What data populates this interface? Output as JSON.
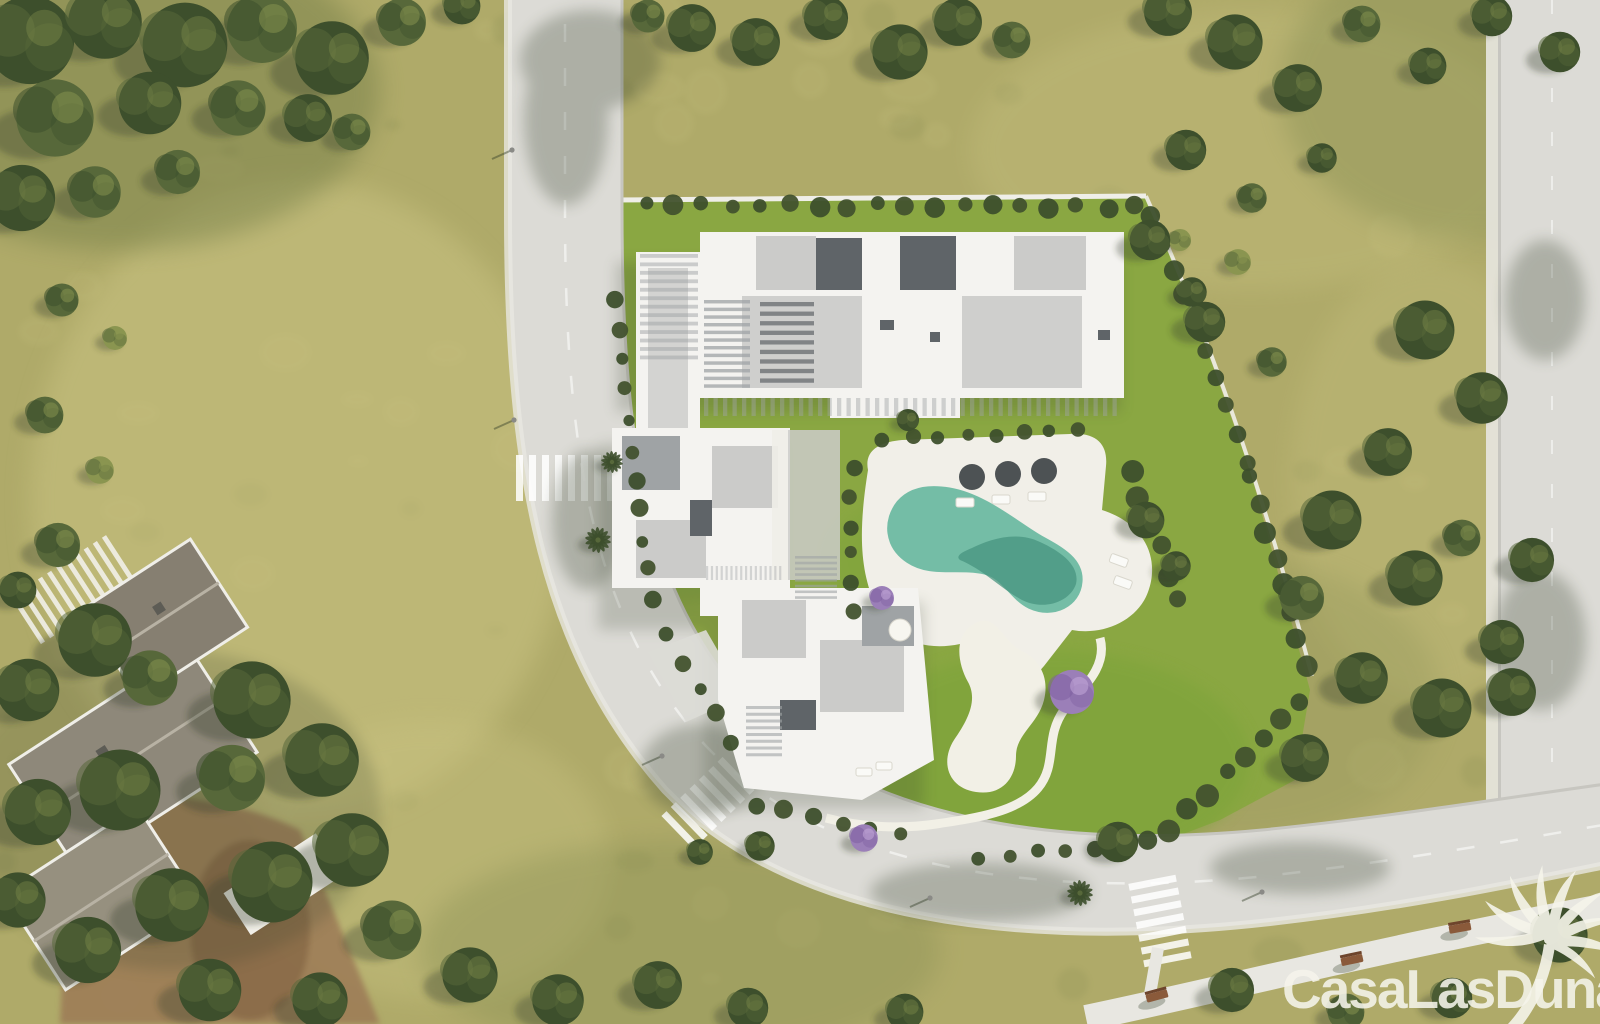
{
  "watermark": {
    "text": "CasaLasDunas",
    "logo": "palm-tree",
    "color": "#f5f4ea",
    "opacity": 0.88
  },
  "palette": {
    "grass_base": "#afaa69",
    "grass_light": "#cbc483",
    "grass_dark": "#868e52",
    "grass_deep": "#6f7a44",
    "plot_lawn": "#8aa742",
    "plot_lawn_light": "#a6ba50",
    "plot_lawn_bright": "#7aa338",
    "road": "#dcdbd6",
    "road_edge": "#c7c6c0",
    "sidewalk": "#e8e7e1",
    "white_line": "#ffffff",
    "building_white": "#f4f3f0",
    "roof_light": "#cbcbc9",
    "roof_mid": "#9fa3a5",
    "roof_dark": "#5f6468",
    "pool_teal": "#74bda6",
    "pool_deep": "#47947f",
    "deck_white": "#f1efe8",
    "sand_white": "#f2f0e6",
    "tree_dark": "#3d4f2c",
    "tree_mid": "#57683a",
    "tree_light": "#8a9550",
    "purple_tree": "#9b7fb8",
    "purple_deep": "#7d5fa0",
    "hedge": "#42522e",
    "shadow": "#36412a",
    "dirt": "#9c7a55",
    "dirt_dark": "#7a5a3e",
    "villa_roof_a": "#8e887a",
    "villa_roof_b": "#867f71",
    "villa_roof_c": "#96907f",
    "ridge": "#b8b2a4",
    "bench": "#8a5a3a",
    "bench_dark": "#6e452c",
    "umbrella_dark": "#3f4446",
    "wall_white": "#efeee8"
  },
  "scene": {
    "trees": [
      [
        30,
        40,
        48,
        "d"
      ],
      [
        105,
        22,
        40,
        "d"
      ],
      [
        185,
        45,
        46,
        "d"
      ],
      [
        262,
        28,
        38,
        "m"
      ],
      [
        332,
        58,
        40,
        "d"
      ],
      [
        55,
        118,
        42,
        "m"
      ],
      [
        150,
        103,
        34,
        "d"
      ],
      [
        238,
        108,
        30,
        "m"
      ],
      [
        22,
        198,
        36,
        "d"
      ],
      [
        95,
        192,
        28,
        "m"
      ],
      [
        402,
        22,
        26,
        "m"
      ],
      [
        462,
        6,
        20,
        "d"
      ],
      [
        308,
        118,
        26,
        "d"
      ],
      [
        178,
        172,
        24,
        "m"
      ],
      [
        352,
        132,
        20,
        "m"
      ],
      [
        648,
        16,
        18,
        "m"
      ],
      [
        692,
        28,
        26,
        "d"
      ],
      [
        756,
        42,
        26,
        "d"
      ],
      [
        826,
        18,
        24,
        "d"
      ],
      [
        900,
        52,
        30,
        "d"
      ],
      [
        958,
        22,
        26,
        "d"
      ],
      [
        1012,
        40,
        20,
        "m"
      ],
      [
        1168,
        12,
        26,
        "d"
      ],
      [
        1235,
        42,
        30,
        "d"
      ],
      [
        1298,
        88,
        26,
        "d"
      ],
      [
        1362,
        24,
        20,
        "m"
      ],
      [
        1428,
        66,
        20,
        "d"
      ],
      [
        1492,
        16,
        22,
        "d"
      ],
      [
        1560,
        52,
        22,
        "d"
      ],
      [
        1186,
        150,
        22,
        "d"
      ],
      [
        1252,
        198,
        16,
        "m"
      ],
      [
        1322,
        158,
        16,
        "d"
      ],
      [
        1205,
        322,
        22,
        "d"
      ],
      [
        1272,
        362,
        16,
        "m"
      ],
      [
        1425,
        330,
        32,
        "d"
      ],
      [
        1482,
        398,
        28,
        "d"
      ],
      [
        1388,
        452,
        26,
        "d"
      ],
      [
        1332,
        520,
        32,
        "d"
      ],
      [
        1415,
        578,
        30,
        "d"
      ],
      [
        1302,
        598,
        24,
        "m"
      ],
      [
        1362,
        678,
        28,
        "d"
      ],
      [
        1305,
        758,
        26,
        "d"
      ],
      [
        1442,
        708,
        32,
        "d"
      ],
      [
        1502,
        642,
        24,
        "d"
      ],
      [
        1462,
        538,
        20,
        "m"
      ],
      [
        1532,
        560,
        24,
        "d"
      ],
      [
        1512,
        692,
        26,
        "d"
      ],
      [
        1238,
        262,
        14,
        "l"
      ],
      [
        1180,
        240,
        12,
        "l"
      ],
      [
        62,
        300,
        18,
        "m"
      ],
      [
        115,
        338,
        13,
        "l"
      ],
      [
        45,
        415,
        20,
        "m"
      ],
      [
        100,
        470,
        15,
        "l"
      ],
      [
        58,
        545,
        24,
        "m"
      ],
      [
        18,
        590,
        20,
        "d"
      ],
      [
        95,
        640,
        40,
        "d"
      ],
      [
        28,
        690,
        34,
        "d"
      ],
      [
        150,
        678,
        30,
        "m"
      ],
      [
        252,
        700,
        42,
        "d"
      ],
      [
        322,
        760,
        40,
        "d"
      ],
      [
        232,
        778,
        36,
        "m"
      ],
      [
        120,
        790,
        44,
        "d"
      ],
      [
        38,
        812,
        36,
        "d"
      ],
      [
        352,
        850,
        40,
        "d"
      ],
      [
        272,
        882,
        44,
        "d"
      ],
      [
        172,
        905,
        40,
        "d"
      ],
      [
        88,
        950,
        36,
        "d"
      ],
      [
        392,
        930,
        32,
        "m"
      ],
      [
        470,
        975,
        30,
        "d"
      ],
      [
        558,
        1000,
        28,
        "d"
      ],
      [
        18,
        900,
        30,
        "d"
      ],
      [
        210,
        990,
        34,
        "d"
      ],
      [
        320,
        1000,
        30,
        "d"
      ],
      [
        658,
        985,
        26,
        "d"
      ],
      [
        748,
        1008,
        22,
        "d"
      ],
      [
        905,
        1012,
        20,
        "d"
      ],
      [
        1118,
        842,
        22,
        "d"
      ],
      [
        1232,
        990,
        24,
        "d"
      ],
      [
        1346,
        1012,
        20,
        "m"
      ],
      [
        1452,
        998,
        22,
        "d"
      ],
      [
        1560,
        935,
        30,
        "d"
      ],
      [
        1150,
        240,
        22,
        "d"
      ],
      [
        1192,
        292,
        16,
        "d"
      ],
      [
        908,
        420,
        12,
        "d"
      ],
      [
        1146,
        520,
        20,
        "d"
      ],
      [
        1176,
        566,
        16,
        "d"
      ],
      [
        882,
        598,
        13,
        "p"
      ],
      [
        1072,
        692,
        24,
        "p"
      ],
      [
        864,
        838,
        15,
        "p"
      ],
      [
        760,
        846,
        16,
        "d"
      ],
      [
        700,
        852,
        14,
        "d"
      ],
      [
        598,
        540,
        13,
        "palm"
      ],
      [
        612,
        462,
        11,
        "palm"
      ],
      [
        1080,
        893,
        13,
        "palm"
      ]
    ],
    "hedges": [
      {
        "x1": 646,
        "y1": 206,
        "x2": 1136,
        "y2": 206,
        "n": 18,
        "r": 8
      },
      {
        "x1": 1150,
        "y1": 214,
        "x2": 1250,
        "y2": 462,
        "n": 10,
        "r": 9
      },
      {
        "x1": 1252,
        "y1": 478,
        "x2": 1306,
        "y2": 668,
        "n": 8,
        "r": 9
      },
      {
        "x1": 1298,
        "y1": 700,
        "x2": 1170,
        "y2": 830,
        "n": 8,
        "r": 9
      },
      {
        "x1": 1150,
        "y1": 842,
        "x2": 980,
        "y2": 858,
        "n": 7,
        "r": 8
      },
      {
        "x1": 616,
        "y1": 300,
        "x2": 652,
        "y2": 600,
        "n": 11,
        "r": 7
      },
      {
        "x1": 668,
        "y1": 636,
        "x2": 730,
        "y2": 740,
        "n": 5,
        "r": 7
      },
      {
        "x1": 852,
        "y1": 470,
        "x2": 852,
        "y2": 610,
        "n": 6,
        "r": 7
      },
      {
        "x1": 884,
        "y1": 438,
        "x2": 1078,
        "y2": 430,
        "n": 8,
        "r": 7
      },
      {
        "x1": 1130,
        "y1": 470,
        "x2": 1180,
        "y2": 600,
        "n": 6,
        "r": 9
      },
      {
        "x1": 756,
        "y1": 806,
        "x2": 900,
        "y2": 836,
        "n": 6,
        "r": 8
      }
    ],
    "crosswalks": [
      {
        "cx": 565,
        "cy": 478,
        "angle": 90,
        "n": 8,
        "len": 46,
        "w": 7,
        "gap": 6
      },
      {
        "cx": 708,
        "cy": 803,
        "angle": 46,
        "n": 7,
        "len": 46,
        "w": 7,
        "gap": 6
      },
      {
        "cx": 1160,
        "cy": 921,
        "angle": -11,
        "n": 7,
        "len": 48,
        "w": 7,
        "gap": 6
      }
    ],
    "benches": [
      {
        "x": 1157,
        "y": 996,
        "a": -15
      },
      {
        "x": 1352,
        "y": 960,
        "a": -12
      },
      {
        "x": 1460,
        "y": 928,
        "a": -10
      }
    ],
    "lamps": [
      [
        512,
        150
      ],
      [
        514,
        420
      ],
      [
        662,
        756
      ],
      [
        930,
        898
      ],
      [
        1262,
        892
      ]
    ],
    "stripe_groups": [
      {
        "x": 704,
        "y": 300,
        "w": 46,
        "h": 92,
        "n": 12,
        "o": "h",
        "c": "roof_mid",
        "op": 0.75
      },
      {
        "x": 760,
        "y": 302,
        "w": 54,
        "h": 86,
        "n": 9,
        "o": "h",
        "c": "roof_dark",
        "op": 0.7
      },
      {
        "x": 704,
        "y": 398,
        "w": 418,
        "h": 18,
        "n": 44,
        "o": "v",
        "c": "roof_mid",
        "op": 0.45
      },
      {
        "x": 640,
        "y": 254,
        "w": 58,
        "h": 110,
        "n": 13,
        "o": "h",
        "c": "roof_mid",
        "op": 0.5
      },
      {
        "x": 795,
        "y": 556,
        "w": 42,
        "h": 46,
        "n": 8,
        "o": "h",
        "c": "roof_mid",
        "op": 0.6
      },
      {
        "x": 746,
        "y": 706,
        "w": 36,
        "h": 54,
        "n": 8,
        "o": "h",
        "c": "roof_mid",
        "op": 0.6
      },
      {
        "x": 706,
        "y": 566,
        "w": 78,
        "h": 14,
        "n": 16,
        "o": "v",
        "c": "roof_mid",
        "op": 0.4
      },
      {
        "x": 16,
        "y": 560,
        "w": 120,
        "h": 56,
        "n": 11,
        "o": "v",
        "c": "building_white",
        "op": 0.85,
        "rot": [
          -33,
          76,
          588
        ]
      }
    ],
    "texture": {
      "light": {
        "n": 70,
        "rmin": 8,
        "rmax": 30,
        "op": 0.15
      },
      "dark": {
        "n": 45,
        "rmin": 8,
        "rmax": 26,
        "op": 0.12
      }
    }
  }
}
